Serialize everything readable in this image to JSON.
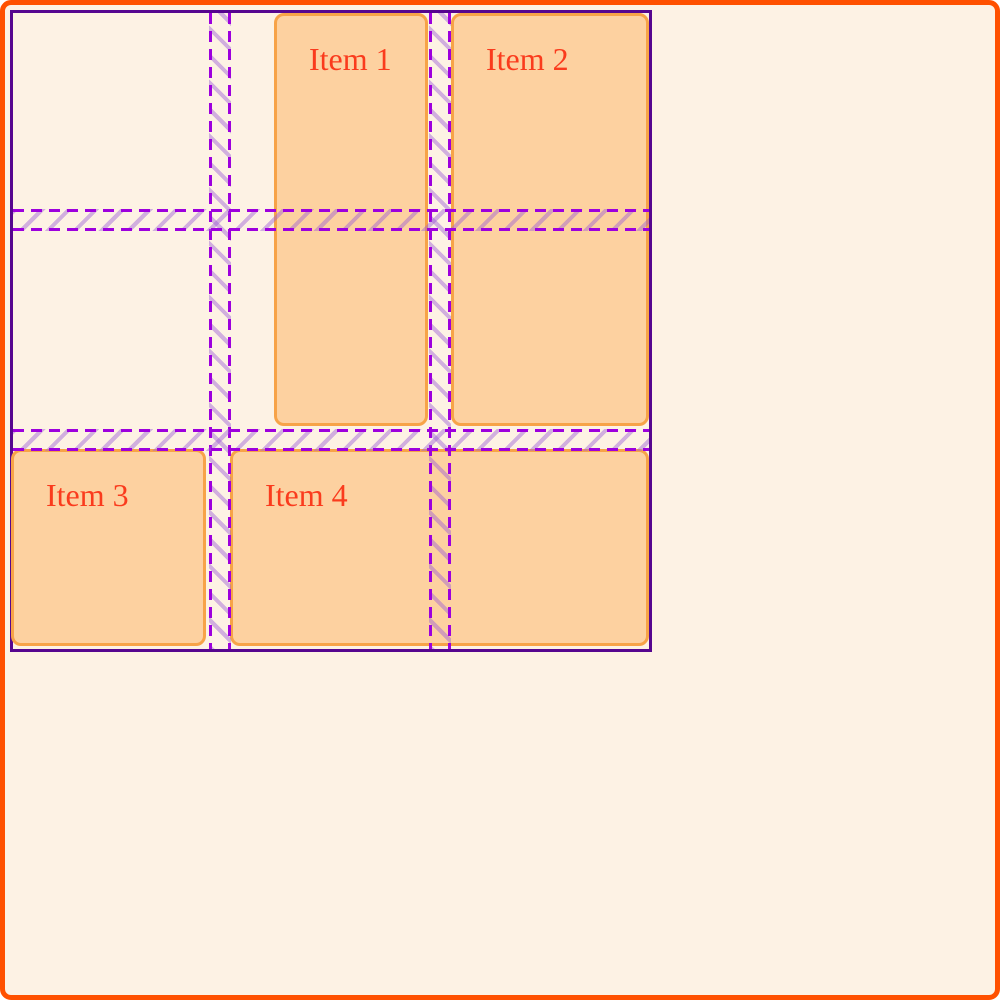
{
  "colors": {
    "page-bg": "#FDF2E4",
    "page-border": "#FF5100",
    "card-bg": "#FDD1A0",
    "card-border": "#F7A348",
    "card-text": "#FA3B1D",
    "grid-border": "#56068F",
    "gap-dash": "#9D00DD",
    "gap-hatch": "rgba(156,93,214,0.45)"
  },
  "grid": {
    "items": [
      {
        "label": "Item 1"
      },
      {
        "label": "Item 2"
      },
      {
        "label": "Item 3"
      },
      {
        "label": "Item 4"
      }
    ]
  }
}
